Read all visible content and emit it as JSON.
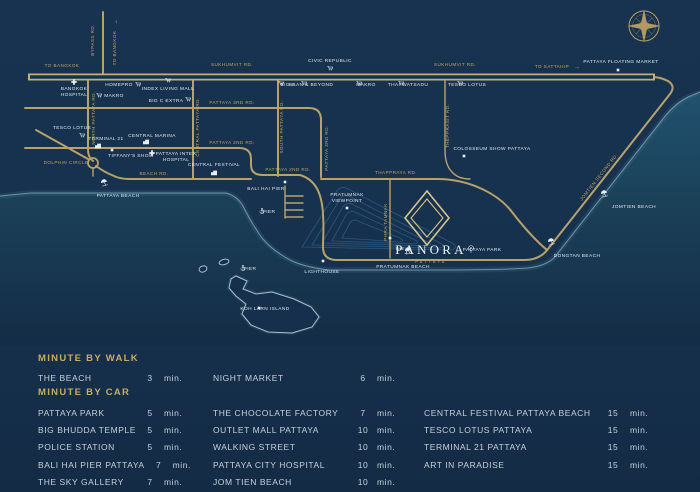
{
  "logo": {
    "prefix": "THE",
    "name": "PANORA",
    "tagline": "PATTAYA"
  },
  "map": {
    "road_labels": [
      {
        "id": "to-bangkok-h",
        "text": "TO BANGKOK",
        "x": 62,
        "y": 67
      },
      {
        "id": "sukhumvit-1",
        "text": "SUKHUMVIT RD.",
        "x": 232,
        "y": 66
      },
      {
        "id": "sukhumvit-2",
        "text": "SUKHUMVIT RD.",
        "x": 455,
        "y": 66
      },
      {
        "id": "to-sattahip",
        "text": "TO SATTAHIP",
        "x": 552,
        "y": 68,
        "arrow": "→",
        "ax": 577,
        "ay": 69
      },
      {
        "id": "bypass-rd",
        "text": "BYPASS RD.",
        "x": 94,
        "y": 40,
        "rot": -90
      },
      {
        "id": "to-bangkok-v",
        "text": "TO BANGKOK",
        "x": 116,
        "y": 48,
        "rot": -90,
        "arrow": "↑",
        "ax": 116,
        "ay": 24
      },
      {
        "id": "pattaya-3rd-h",
        "text": "PATTAYA 3RD RD.",
        "x": 232,
        "y": 104
      },
      {
        "id": "pattaya-2nd-h",
        "text": "PATTAYA 2ND RD.",
        "x": 232,
        "y": 144
      },
      {
        "id": "pattaya-2nd-s",
        "text": "PATTAYA 2ND RD.",
        "x": 288,
        "y": 171
      },
      {
        "id": "pattaya-3rd-v",
        "text": "PATTAYA 3RD RD.",
        "x": 328,
        "y": 148,
        "rot": -90
      },
      {
        "id": "beach-rd",
        "text": "BEACH RD.",
        "x": 154,
        "y": 175
      },
      {
        "id": "thappraya-rd",
        "text": "THAPPRAYA RD.",
        "x": 396,
        "y": 174
      },
      {
        "id": "north-pattaya-rd",
        "text": "NORTH PATTAYA RD.",
        "x": 95,
        "y": 118,
        "rot": -90
      },
      {
        "id": "central-pattaya-rd",
        "text": "CENTRAL PATTAYA RD.",
        "x": 199,
        "y": 127,
        "rot": -90
      },
      {
        "id": "south-pattaya-rd",
        "text": "SOUTH PATTAYA RD.",
        "x": 283,
        "y": 127,
        "rot": -90
      },
      {
        "id": "thepprasit-rd",
        "text": "THEPPRASIT RD.",
        "x": 449,
        "y": 126,
        "rot": -90
      },
      {
        "id": "phra-tamnak",
        "text": "PHRA TAMNAK",
        "x": 387,
        "y": 222,
        "rot": -90
      },
      {
        "id": "jomtien-second-rd",
        "text": "JOMTIEN SECOND RD.",
        "x": 600,
        "y": 178,
        "rot": -52
      },
      {
        "id": "dolphin-circle",
        "text": "DOLPHIN CIRCLE",
        "x": 66,
        "y": 164
      }
    ],
    "pois": [
      {
        "id": "bangkok-hospital",
        "icon": "cross",
        "ix": 74,
        "iy": 82,
        "lines": [
          {
            "t": "BANGKOK",
            "x": 74,
            "y": 90
          },
          {
            "t": "HOSPITAL",
            "x": 74,
            "y": 96
          }
        ]
      },
      {
        "id": "homepro",
        "icon": "cart",
        "ix": 138,
        "iy": 84,
        "lines": [
          {
            "t": "HOMEPRO",
            "x": 119,
            "y": 86
          }
        ]
      },
      {
        "id": "makro-left",
        "icon": "cart",
        "ix": 99,
        "iy": 95,
        "lines": [
          {
            "t": "MAKRO",
            "x": 114,
            "y": 97
          }
        ]
      },
      {
        "id": "index-living-mall",
        "icon": "cart",
        "ix": 168,
        "iy": 80,
        "lines": [
          {
            "t": "INDEX LIVING MALL",
            "x": 168,
            "y": 90
          }
        ]
      },
      {
        "id": "big-c-extra",
        "icon": "cart",
        "ix": 188,
        "iy": 99,
        "lines": [
          {
            "t": "BIG C EXTRA",
            "x": 166,
            "y": 102
          }
        ]
      },
      {
        "id": "civic-republic",
        "icon": "cart",
        "ix": 330,
        "iy": 68,
        "lines": [
          {
            "t": "CIVIC REPUBLIC",
            "x": 330,
            "y": 62
          }
        ]
      },
      {
        "id": "big-c",
        "icon": "cart",
        "ix": 281,
        "iy": 83,
        "lines": [
          {
            "t": "BIG C",
            "x": 288,
            "y": 86,
            "anchor": "start"
          }
        ]
      },
      {
        "id": "baan-and-beyond",
        "icon": "cart",
        "ix": 304,
        "iy": 83,
        "lines": [
          {
            "t": "BAAN & BEYOND",
            "x": 311,
            "y": 86,
            "anchor": "start"
          }
        ]
      },
      {
        "id": "makro-2",
        "icon": "cart",
        "ix": 359,
        "iy": 83,
        "lines": [
          {
            "t": "MAKRO",
            "x": 366,
            "y": 86,
            "anchor": "start"
          }
        ]
      },
      {
        "id": "thai-watsadu",
        "icon": "cart",
        "ix": 401,
        "iy": 83,
        "lines": [
          {
            "t": "THAI WATSADU",
            "x": 408,
            "y": 86,
            "anchor": "start"
          }
        ]
      },
      {
        "id": "tesco-lotus-2",
        "icon": "cart",
        "ix": 460,
        "iy": 83,
        "lines": [
          {
            "t": "TESCO LOTUS",
            "x": 467,
            "y": 86,
            "anchor": "start"
          }
        ]
      },
      {
        "id": "tesco-lotus-left",
        "icon": "cart",
        "ix": 82,
        "iy": 135,
        "lines": [
          {
            "t": "TESCO LOTUS",
            "x": 72,
            "y": 129
          }
        ]
      },
      {
        "id": "central-marina",
        "icon": "building",
        "ix": 146,
        "iy": 142,
        "lines": [
          {
            "t": "CENTRAL MARINA",
            "x": 152,
            "y": 137
          }
        ]
      },
      {
        "id": "terminal-21",
        "icon": "building",
        "ix": 98,
        "iy": 146,
        "lines": [
          {
            "t": "TERMINAL 21",
            "x": 106,
            "y": 140
          }
        ]
      },
      {
        "id": "tiffanys-show",
        "icon": "dot",
        "ix": 112,
        "iy": 150,
        "lines": [
          {
            "t": "TIFFANY'S SHOW",
            "x": 131,
            "y": 157
          }
        ]
      },
      {
        "id": "pattaya-inter-hospital",
        "icon": "cross",
        "ix": 152,
        "iy": 153,
        "lines": [
          {
            "t": "PATTAYA INTER",
            "x": 176,
            "y": 155
          },
          {
            "t": "HOSPITAL",
            "x": 176,
            "y": 161
          }
        ]
      },
      {
        "id": "central-festival",
        "icon": "building",
        "ix": 214,
        "iy": 173,
        "lines": [
          {
            "t": "CENTRAL FESTIVAL",
            "x": 214,
            "y": 166
          }
        ]
      },
      {
        "id": "colosseum-show",
        "icon": "dot",
        "ix": 464,
        "iy": 156,
        "lines": [
          {
            "t": "COLOSSEUM SHOW PATTAYA",
            "x": 492,
            "y": 150
          }
        ]
      },
      {
        "id": "floating-market",
        "icon": "dot",
        "ix": 618,
        "iy": 70,
        "lines": [
          {
            "t": "PATTAYA FLOATING MARKET",
            "x": 621,
            "y": 63
          }
        ]
      },
      {
        "id": "bali-hai-pier",
        "icon": "dot",
        "ix": 285,
        "iy": 182,
        "lines": [
          {
            "t": "BALI HAI PIER",
            "x": 266,
            "y": 190
          }
        ]
      },
      {
        "id": "pier-mainland",
        "icon": "anchor",
        "ix": 262,
        "iy": 211,
        "lines": [
          {
            "t": "PIER",
            "x": 269,
            "y": 213,
            "anchor": "start"
          }
        ]
      },
      {
        "id": "lighthouse",
        "icon": "dot",
        "ix": 323,
        "iy": 261,
        "lines": [
          {
            "t": "LIGHTHOUSE",
            "x": 322,
            "y": 273
          }
        ]
      },
      {
        "id": "pratumnak-viewpoint",
        "icon": "dot",
        "ix": 347,
        "iy": 208,
        "lines": [
          {
            "t": "PRATUMNAK",
            "x": 347,
            "y": 196
          },
          {
            "t": "VIEWPOINT",
            "x": 347,
            "y": 202
          }
        ]
      },
      {
        "id": "pattaya-park",
        "icon": "tower",
        "ix": 471,
        "iy": 248,
        "lines": [
          {
            "t": "PATTAYA PARK",
            "x": 482,
            "y": 251,
            "anchor": "start"
          }
        ]
      },
      {
        "id": "pattaya-beach",
        "icon": "umbrella",
        "ix": 104,
        "iy": 182,
        "lines": [
          {
            "t": "PATTAYA BEACH",
            "x": 118,
            "y": 197
          }
        ]
      },
      {
        "id": "pratumnak-beach",
        "icon": "umbrella",
        "ix": 408,
        "iy": 250,
        "lines": [
          {
            "t": "PRATUMNAK BEACH",
            "x": 403,
            "y": 268
          }
        ]
      },
      {
        "id": "dongtan-beach",
        "icon": "umbrella",
        "ix": 551,
        "iy": 241,
        "lines": [
          {
            "t": "DONGTAN BEACH",
            "x": 577,
            "y": 257
          }
        ]
      },
      {
        "id": "jomtien-beach",
        "icon": "umbrella",
        "ix": 604,
        "iy": 193,
        "lines": [
          {
            "t": "JOMTIEN BEACH",
            "x": 634,
            "y": 208
          }
        ]
      },
      {
        "id": "koh-larn",
        "icon": "dot",
        "ix": 259,
        "iy": 308,
        "lines": [
          {
            "t": "KOH LARN ISLAND",
            "x": 265,
            "y": 310,
            "anchor": "start"
          }
        ]
      },
      {
        "id": "pier-island",
        "icon": "anchor",
        "ix": 243,
        "iy": 268,
        "lines": [
          {
            "t": "PIER",
            "x": 250,
            "y": 270,
            "anchor": "start"
          }
        ]
      },
      {
        "id": "panora-site",
        "icon": "dot",
        "ix": 390,
        "iy": 238,
        "lines": []
      }
    ]
  },
  "legend": {
    "walk": {
      "title": "MINUTE BY WALK",
      "rows": [
        {
          "name": "THE BEACH",
          "value": "3",
          "unit": "min."
        },
        {
          "name": "NIGHT MARKET",
          "value": "6",
          "unit": "min."
        }
      ]
    },
    "car": {
      "title": "MINUTE BY CAR",
      "cols": [
        [
          {
            "name": "PATTAYA PARK",
            "value": "5",
            "unit": "min."
          },
          {
            "name": "BIG BHUDDA TEMPLE",
            "value": "5",
            "unit": "min."
          },
          {
            "name": "POLICE STATION",
            "value": "5",
            "unit": "min."
          },
          {
            "name": "BALI HAI PIER PATTAYA",
            "value": "7",
            "unit": "min."
          },
          {
            "name": "THE SKY GALLERY",
            "value": "7",
            "unit": "min."
          }
        ],
        [
          {
            "name": "THE CHOCOLATE FACTORY",
            "value": "7",
            "unit": "min."
          },
          {
            "name": "OUTLET MALL PATTAYA",
            "value": "10",
            "unit": "min."
          },
          {
            "name": "WALKING STREET",
            "value": "10",
            "unit": "min."
          },
          {
            "name": "PATTAYA CITY HOSPITAL",
            "value": "10",
            "unit": "min."
          },
          {
            "name": "JOM TIEN BEACH",
            "value": "10",
            "unit": "min."
          }
        ],
        [
          {
            "name": "CENTRAL FESTIVAL PATTAYA BEACH",
            "value": "15",
            "unit": "min."
          },
          {
            "name": "TESCO LOTUS PATTAYA",
            "value": "15",
            "unit": "min."
          },
          {
            "name": "TERMINAL 21 PATTAYA",
            "value": "15",
            "unit": "min."
          },
          {
            "name": "ART IN PARADISE",
            "value": "15",
            "unit": "min."
          }
        ]
      ]
    }
  }
}
